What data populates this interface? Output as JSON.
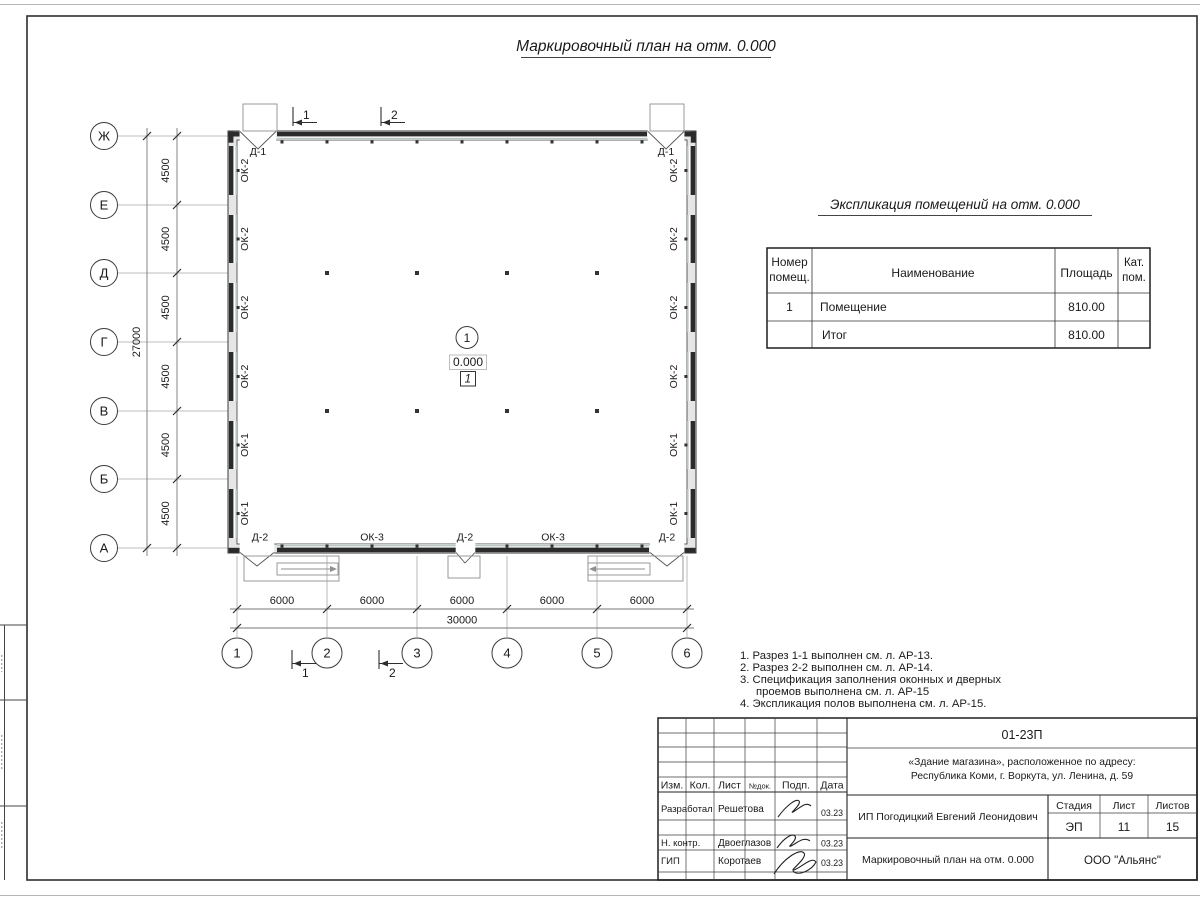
{
  "sheet": {
    "title": "Маркировочный план на отм. 0.000"
  },
  "plan": {
    "axes_rows": [
      "Ж",
      "Е",
      "Д",
      "Г",
      "В",
      "Б",
      "А"
    ],
    "axes_cols": [
      "1",
      "2",
      "3",
      "4",
      "5",
      "6"
    ],
    "row_dims": [
      "4500",
      "4500",
      "4500",
      "4500",
      "4500",
      "4500"
    ],
    "row_total": "27000",
    "col_dims": [
      "6000",
      "6000",
      "6000",
      "6000",
      "6000"
    ],
    "col_total": "30000",
    "windows_left": [
      "ОК-2",
      "ОК-2",
      "ОК-2",
      "ОК-2",
      "ОК-1",
      "ОК-1"
    ],
    "windows_right": [
      "ОК-2",
      "ОК-2",
      "ОК-2",
      "ОК-2",
      "ОК-1",
      "ОК-1"
    ],
    "door_top_left": "Д-1",
    "door_top_right": "Д-1",
    "bottom_marks": [
      "Д-2",
      "ОК-3",
      "Д-2",
      "ОК-3",
      "Д-2"
    ],
    "section_top": [
      "1",
      "2"
    ],
    "section_bottom": [
      "1",
      "2"
    ],
    "room": {
      "axis_ref": "1",
      "elevation": "0.000",
      "number": "1"
    }
  },
  "explication": {
    "title": "Экспликация помещений на отм. 0.000",
    "headers": {
      "num1": "Номер",
      "num2": "помещ.",
      "name": "Наименование",
      "area": "Площадь",
      "cat1": "Кат.",
      "cat2": "пом."
    },
    "rows": [
      {
        "num": "1",
        "name": "Помещение",
        "area": "810.00",
        "cat": ""
      },
      {
        "num": "",
        "name": "Итог",
        "area": "810.00",
        "cat": ""
      }
    ]
  },
  "notes": {
    "line1": "1. Разрез 1-1 выполнен см. л. АР-13.",
    "line2": "2. Разрез 2-2 выполнен см. л. АР-14.",
    "line3": "3. Спецификация заполнения оконных и дверных",
    "line4": "проемов выполнена см. л. АР-15",
    "line5": "4. Экспликация полов выполнена см. л. АР-15."
  },
  "titleblock": {
    "code": "01-23П",
    "address1": "«Здание магазина», расположенное по адресу:",
    "address2": "Республика Коми, г. Воркута, ул. Ленина, д. 59",
    "client": "ИП Погодицкий Евгений Леонидович",
    "doc_title": "Маркировочный план на отм. 0.000",
    "company": "ООО \"Альянс\"",
    "cols": {
      "izm": "Изм.",
      "kol": "Кол.",
      "list": "Лист",
      "ndok": "№док.",
      "podp": "Подп.",
      "data": "Дата"
    },
    "stage_label": "Стадия",
    "sheet_label": "Лист",
    "sheets_label": "Листов",
    "stage": "ЭП",
    "sheet_no": "11",
    "sheets_total": "15",
    "roles": [
      {
        "role": "Разработал",
        "name": "Решетова",
        "date": "03.23"
      },
      {
        "role": "Н. контр.",
        "name": "Двоеглазов",
        "date": "03.23"
      },
      {
        "role": "ГИП",
        "name": "Коротаев",
        "date": "03.23"
      }
    ]
  }
}
